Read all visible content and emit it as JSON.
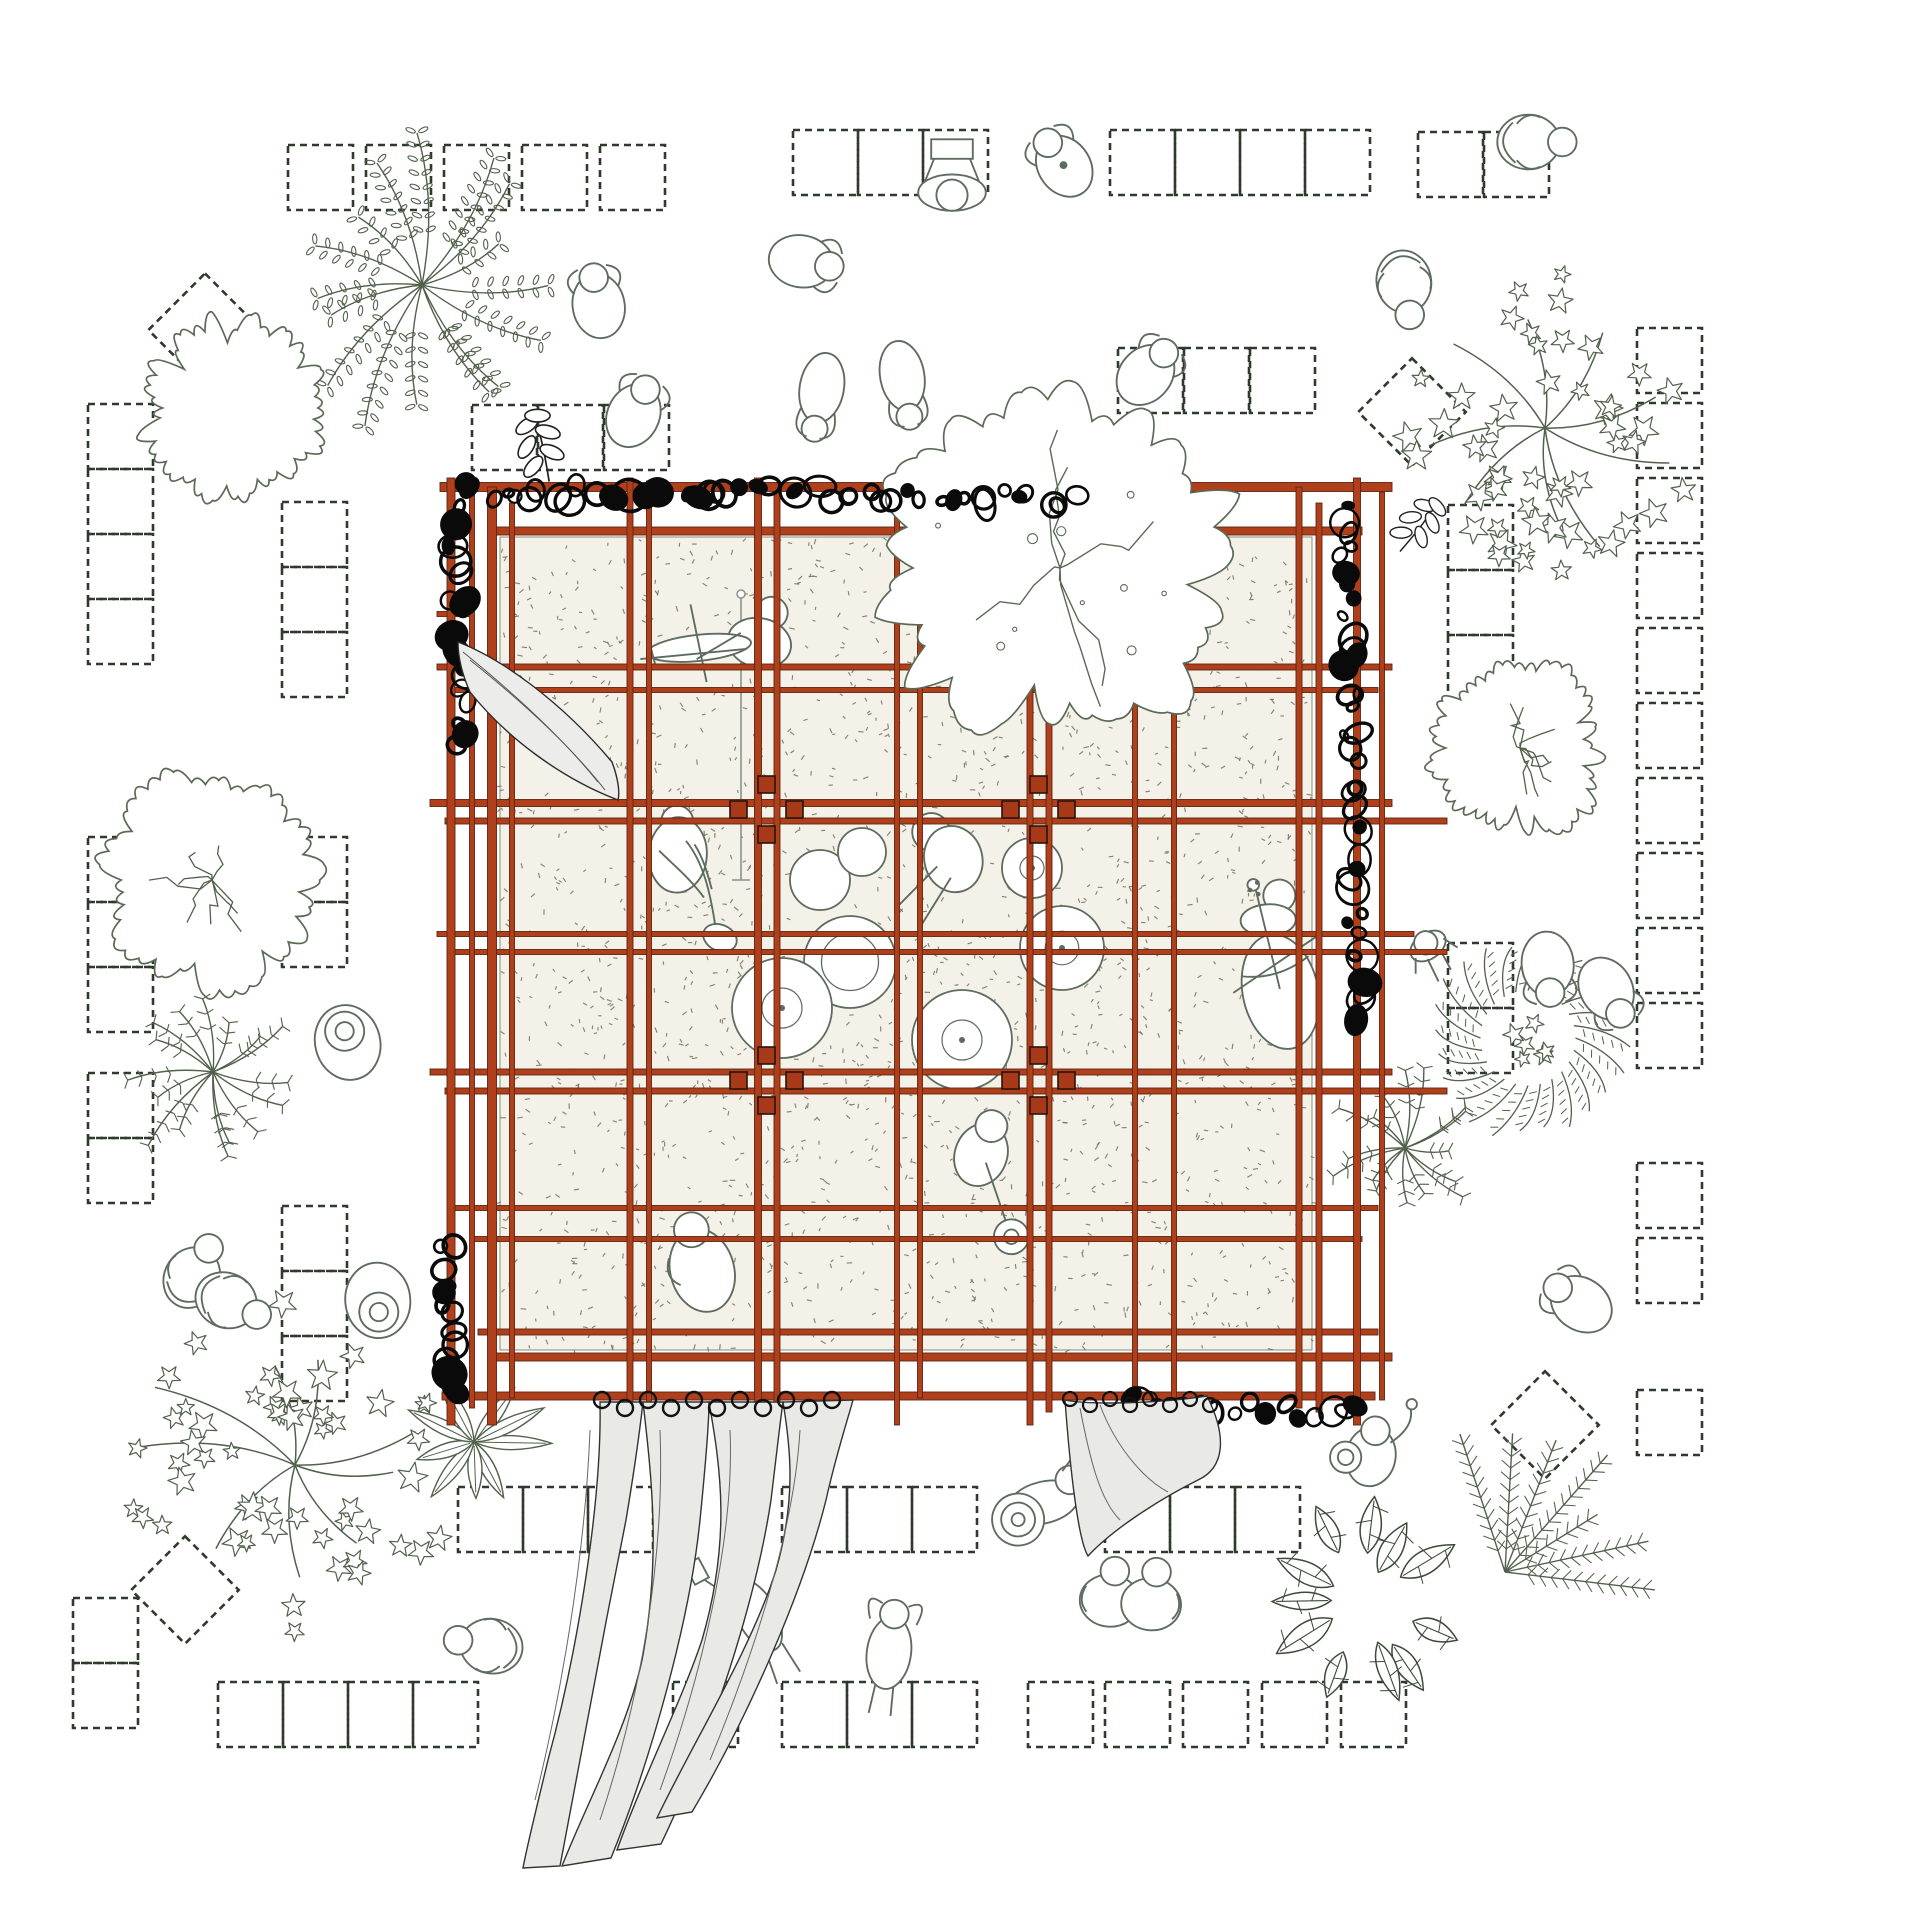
{
  "meta": {
    "drawing": "pavilion-site-plan",
    "width": 1920,
    "height": 1920
  },
  "colors": {
    "background": "#ffffff",
    "beam": "#b0401c",
    "beam_edge": "#5e2512",
    "column": "#a83918",
    "column_edge": "#26150d",
    "fill": "#f3f1e8",
    "fill_edge": "#8a8a78",
    "stipple": "#72725c",
    "dash": "#2d3a2c",
    "person": "#5d6c5e",
    "tree": "#51614b",
    "tree_dark": "#3c4a38",
    "cloud": "#5a6a55",
    "scribble": "#0a0a0a",
    "curtain_fill": "#e9e9e6",
    "curtain_edge": "#333333",
    "drape_fill": "#ececea",
    "mic": "#8a938a"
  },
  "pavilion": {
    "fill": {
      "x": 500,
      "y": 537,
      "w": 812,
      "h": 813
    },
    "stipple": {
      "count": 2100,
      "seed": 7
    },
    "verticals": [
      [
        451,
        8,
        478,
        1425
      ],
      [
        472,
        5,
        492,
        1408
      ],
      [
        492,
        9,
        487,
        1425
      ],
      [
        512,
        5,
        503,
        1398
      ],
      [
        630,
        6,
        478,
        1425
      ],
      [
        649,
        5,
        481,
        1425
      ],
      [
        758,
        7,
        478,
        1425
      ],
      [
        777,
        6,
        492,
        1410
      ],
      [
        897,
        5,
        478,
        1425
      ],
      [
        920,
        5,
        503,
        1398
      ],
      [
        1030,
        6,
        492,
        1425
      ],
      [
        1049,
        6,
        478,
        1412
      ],
      [
        1135,
        5,
        492,
        1408
      ],
      [
        1174,
        5,
        478,
        1400
      ],
      [
        1299,
        6,
        487,
        1408
      ],
      [
        1319,
        6,
        503,
        1412
      ],
      [
        1357,
        7,
        478,
        1425
      ],
      [
        1382,
        5,
        492,
        1400
      ]
    ],
    "horizontals": [
      [
        487,
        9,
        440,
        1392
      ],
      [
        531,
        8,
        488,
        1362
      ],
      [
        614,
        5,
        437,
        470
      ],
      [
        667,
        6,
        437,
        1392
      ],
      [
        690,
        5,
        451,
        1378
      ],
      [
        803,
        7,
        430,
        1392
      ],
      [
        821,
        6,
        445,
        1447
      ],
      [
        934,
        5,
        437,
        1414
      ],
      [
        952,
        5,
        451,
        1447
      ],
      [
        1072,
        6,
        430,
        1392
      ],
      [
        1091,
        6,
        445,
        1447
      ],
      [
        1208,
        5,
        451,
        1378
      ],
      [
        1239,
        5,
        472,
        1362
      ],
      [
        1332,
        6,
        478,
        1378
      ],
      [
        1357,
        8,
        495,
        1392
      ],
      [
        1396,
        8,
        442,
        1375
      ]
    ],
    "nodes": [
      [
        767,
        810
      ],
      [
        1039,
        810
      ],
      [
        767,
        1081
      ],
      [
        1039,
        1081
      ]
    ],
    "node_squares": [
      [
        -9,
        -34,
        17
      ],
      [
        -37,
        -9,
        17
      ],
      [
        19,
        -9,
        17
      ],
      [
        -9,
        16,
        17
      ]
    ],
    "mic_stand": {
      "x": 741,
      "y1": 598,
      "y2": 880
    }
  },
  "paving": {
    "size": 65,
    "dash": "7 5",
    "stroke_w": 2.6,
    "rows": [
      {
        "x": 288,
        "y": 145,
        "n": 5,
        "step": 78
      },
      {
        "x": 793,
        "y": 130,
        "n": 3,
        "step": 65
      },
      {
        "x": 1110,
        "y": 130,
        "n": 4,
        "step": 65
      },
      {
        "x": 1418,
        "y": 132,
        "n": 2,
        "step": 66
      },
      {
        "x": 472,
        "y": 405,
        "n": 3,
        "step": 66
      },
      {
        "x": 1118,
        "y": 348,
        "n": 3,
        "step": 66
      },
      {
        "x": 458,
        "y": 1487,
        "n": 3,
        "step": 65
      },
      {
        "x": 782,
        "y": 1487,
        "n": 3,
        "step": 65
      },
      {
        "x": 1105,
        "y": 1487,
        "n": 3,
        "step": 65
      },
      {
        "x": 218,
        "y": 1682,
        "n": 4,
        "step": 65
      },
      {
        "x": 673,
        "y": 1682,
        "n": 1,
        "step": 65
      },
      {
        "x": 782,
        "y": 1682,
        "n": 3,
        "step": 65
      },
      {
        "x": 1028,
        "y": 1682,
        "n": 2,
        "step": 77
      },
      {
        "x": 1183,
        "y": 1682,
        "n": 3,
        "step": 79
      }
    ],
    "cols": [
      {
        "x": 88,
        "y": 404,
        "n": 4,
        "step": 65
      },
      {
        "x": 88,
        "y": 837,
        "n": 3,
        "step": 65
      },
      {
        "x": 88,
        "y": 1073,
        "n": 2,
        "step": 65
      },
      {
        "x": 282,
        "y": 502,
        "n": 3,
        "step": 65
      },
      {
        "x": 282,
        "y": 837,
        "n": 2,
        "step": 65
      },
      {
        "x": 282,
        "y": 1206,
        "n": 3,
        "step": 65
      },
      {
        "x": 73,
        "y": 1598,
        "n": 2,
        "step": 65
      },
      {
        "x": 1448,
        "y": 505,
        "n": 3,
        "step": 65
      },
      {
        "x": 1448,
        "y": 943,
        "n": 2,
        "step": 65
      },
      {
        "x": 1637,
        "y": 328,
        "n": 6,
        "step": 75
      },
      {
        "x": 1637,
        "y": 778,
        "n": 4,
        "step": 75
      },
      {
        "x": 1637,
        "y": 1163,
        "n": 2,
        "step": 75
      },
      {
        "x": 1637,
        "y": 1390,
        "n": 1,
        "step": 75
      }
    ],
    "diamonds": [
      {
        "x": 205,
        "y": 330,
        "r": 40
      },
      {
        "x": 1412,
        "y": 412,
        "r": 38
      },
      {
        "x": 1545,
        "y": 1425,
        "r": 38
      },
      {
        "x": 185,
        "y": 1590,
        "r": 38
      }
    ]
  },
  "trees": [
    {
      "type": "fern",
      "x": 422,
      "y": 285,
      "r": 165,
      "seed": 11,
      "style": "leaf"
    },
    {
      "type": "cloud",
      "x": 232,
      "y": 408,
      "r": 95,
      "seed": 21,
      "scribble": false
    },
    {
      "type": "cloud",
      "x": 212,
      "y": 880,
      "r": 112,
      "seed": 31,
      "scribble": true
    },
    {
      "type": "fern",
      "x": 213,
      "y": 1072,
      "r": 100,
      "seed": 41,
      "style": "fine"
    },
    {
      "type": "ivy",
      "x": 295,
      "y": 1465,
      "r": 170,
      "seed": 51
    },
    {
      "type": "ivy",
      "x": 1545,
      "y": 428,
      "r": 155,
      "seed": 61
    },
    {
      "type": "cloud",
      "x": 1520,
      "y": 748,
      "r": 90,
      "seed": 71,
      "scribble": true
    },
    {
      "type": "wreath",
      "x": 1528,
      "y": 1038,
      "r": 95,
      "seed": 81
    },
    {
      "type": "fern",
      "x": 1405,
      "y": 1148,
      "r": 85,
      "seed": 91,
      "style": "fine"
    },
    {
      "type": "frond",
      "x": 1505,
      "y": 1572,
      "r": 150,
      "seed": 101
    },
    {
      "type": "monstera",
      "x": 1362,
      "y": 1600,
      "r": 95,
      "seed": 111
    },
    {
      "type": "leafplant",
      "x": 474,
      "y": 1442,
      "r": 75,
      "seed": 121
    }
  ],
  "canopy": {
    "x": 1060,
    "y": 568,
    "rx": 195,
    "ry": 185,
    "seed": 131
  },
  "sprigs": [
    {
      "x": 545,
      "y": 466,
      "rot": -15,
      "s": 1.15
    },
    {
      "x": 1408,
      "y": 540,
      "rot": 35,
      "s": 1.0
    }
  ],
  "scribbles": [
    {
      "x1": 462,
      "y1": 492,
      "x2": 1072,
      "y2": 497,
      "seed": 3,
      "n": 46
    },
    {
      "x1": 456,
      "y1": 502,
      "x2": 463,
      "y2": 748,
      "seed": 5,
      "n": 20
    },
    {
      "x1": 446,
      "y1": 1240,
      "x2": 456,
      "y2": 1396,
      "seed": 9,
      "n": 13
    },
    {
      "x1": 1347,
      "y1": 508,
      "x2": 1358,
      "y2": 1018,
      "seed": 13,
      "n": 38
    },
    {
      "x1": 1128,
      "y1": 1402,
      "x2": 1352,
      "y2": 1414,
      "seed": 17,
      "n": 18
    }
  ],
  "curtains": {
    "drape": {
      "path": "M458,642 C500,658 560,700 612,762 C618,778 620,792 618,800 C560,778 505,736 470,692 C462,674 458,656 458,642 Z",
      "folds": [
        "M470,660 C520,700 570,745 605,790",
        "M463,652 C510,690 560,735 598,782"
      ]
    },
    "main": {
      "strips": [
        "M600,1402 C602,1500 578,1650 548,1760 C538,1802 527,1846 523,1868 L560,1866 C576,1780 602,1640 626,1520 C636,1460 641,1420 643,1402 Z",
        "M643,1402 C652,1480 661,1560 642,1660 C627,1730 588,1800 562,1866 L611,1858 C651,1760 690,1620 700,1520 C706,1460 709,1420 709,1402 Z",
        "M709,1402 C721,1470 731,1540 702,1640 C682,1700 642,1780 617,1850 L661,1844 C711,1740 756,1600 771,1500 C777,1450 781,1415 783,1402 Z",
        "M783,1402 C791,1450 796,1500 776,1570 C751,1650 692,1744 657,1818 L692,1812 C742,1728 801,1600 826,1500 C836,1455 849,1415 853,1400 Z"
      ],
      "folds": [
        "M590,1430 C585,1560 560,1700 535,1800",
        "M660,1430 C665,1560 640,1700 600,1820",
        "M730,1430 C735,1540 700,1680 660,1790",
        "M800,1430 C795,1520 760,1640 710,1760"
      ],
      "rings": {
        "x0": 602,
        "step": 23,
        "n": 11,
        "y": 1403,
        "r": 8
      }
    },
    "right": {
      "path": "M1065,1400 C1095,1406 1170,1402 1207,1396 C1228,1438 1224,1468 1198,1480 C1158,1500 1112,1530 1088,1556 C1078,1540 1070,1468 1065,1400 Z",
      "folds": [
        "M1080,1408 C1090,1460 1100,1500 1120,1520",
        "M1100,1405 C1115,1445 1142,1478 1168,1492"
      ],
      "rings": {
        "x0": 1070,
        "step": 20,
        "n": 8,
        "y": 1401,
        "r": 7
      }
    }
  },
  "people": [
    {
      "pose": "crouch",
      "x": 598,
      "y": 302,
      "rot": -10
    },
    {
      "pose": "crouch",
      "x": 805,
      "y": 262,
      "rot": 100
    },
    {
      "pose": "stand",
      "x": 952,
      "y": 190,
      "rot": 180
    },
    {
      "pose": "dot",
      "x": 1062,
      "y": 163,
      "rot": -35
    },
    {
      "pose": "sit",
      "x": 1405,
      "y": 288,
      "rot": 170
    },
    {
      "pose": "sit",
      "x": 1535,
      "y": 142,
      "rot": 90
    },
    {
      "pose": "bend",
      "x": 820,
      "y": 398,
      "rot": -170
    },
    {
      "pose": "bend",
      "x": 904,
      "y": 386,
      "rot": 170
    },
    {
      "pose": "crouch",
      "x": 1148,
      "y": 372,
      "rot": 40
    },
    {
      "pose": "crouch",
      "x": 635,
      "y": 412,
      "rot": 25
    },
    {
      "pose": "hat",
      "x": 347,
      "y": 1040,
      "rot": -15
    },
    {
      "pose": "sit",
      "x": 195,
      "y": 1272,
      "rot": 30
    },
    {
      "pose": "sit",
      "x": 232,
      "y": 1303,
      "rot": 115
    },
    {
      "pose": "hat",
      "x": 378,
      "y": 1303,
      "rot": 175
    },
    {
      "pose": "lie_phone",
      "x": 752,
      "y": 1606,
      "rot": -28
    },
    {
      "pose": "lie_rest",
      "x": 890,
      "y": 1645,
      "rot": 8
    },
    {
      "pose": "sit",
      "x": 485,
      "y": 1645,
      "rot": -80
    },
    {
      "pose": "tuba",
      "x": 1032,
      "y": 1500,
      "rot": -14
    },
    {
      "pose": "couple",
      "x": 1130,
      "y": 1592,
      "rot": 5
    },
    {
      "pose": "crouch",
      "x": 1548,
      "y": 968,
      "rot": 175
    },
    {
      "pose": "crouch",
      "x": 1608,
      "y": 992,
      "rot": 150
    },
    {
      "pose": "walk",
      "x": 1428,
      "y": 946,
      "rot": -35
    },
    {
      "pose": "horn",
      "x": 1372,
      "y": 1450,
      "rot": 10
    },
    {
      "pose": "crouch",
      "x": 1578,
      "y": 1302,
      "rot": -55
    }
  ],
  "musicians": [
    {
      "pose": "violin",
      "x": 760,
      "y": 640,
      "rot": 12
    },
    {
      "pose": "sax",
      "x": 678,
      "y": 852,
      "rot": 4
    },
    {
      "pose": "drummer",
      "x": 948,
      "y": 856,
      "rot": -15
    },
    {
      "pose": "cello",
      "x": 1272,
      "y": 952,
      "rot": -12
    },
    {
      "pose": "banjo",
      "x": 982,
      "y": 1152,
      "rot": 20
    },
    {
      "pose": "sitin",
      "x": 700,
      "y": 1262,
      "rot": -15
    }
  ],
  "drums": {
    "circles": [
      [
        820,
        880,
        30,
        0
      ],
      [
        862,
        852,
        24,
        0
      ],
      [
        850,
        962,
        46,
        1
      ],
      [
        782,
        1008,
        50,
        2
      ],
      [
        962,
        1040,
        50,
        2
      ],
      [
        1062,
        948,
        42,
        2
      ],
      [
        1032,
        868,
        30,
        2
      ]
    ]
  }
}
